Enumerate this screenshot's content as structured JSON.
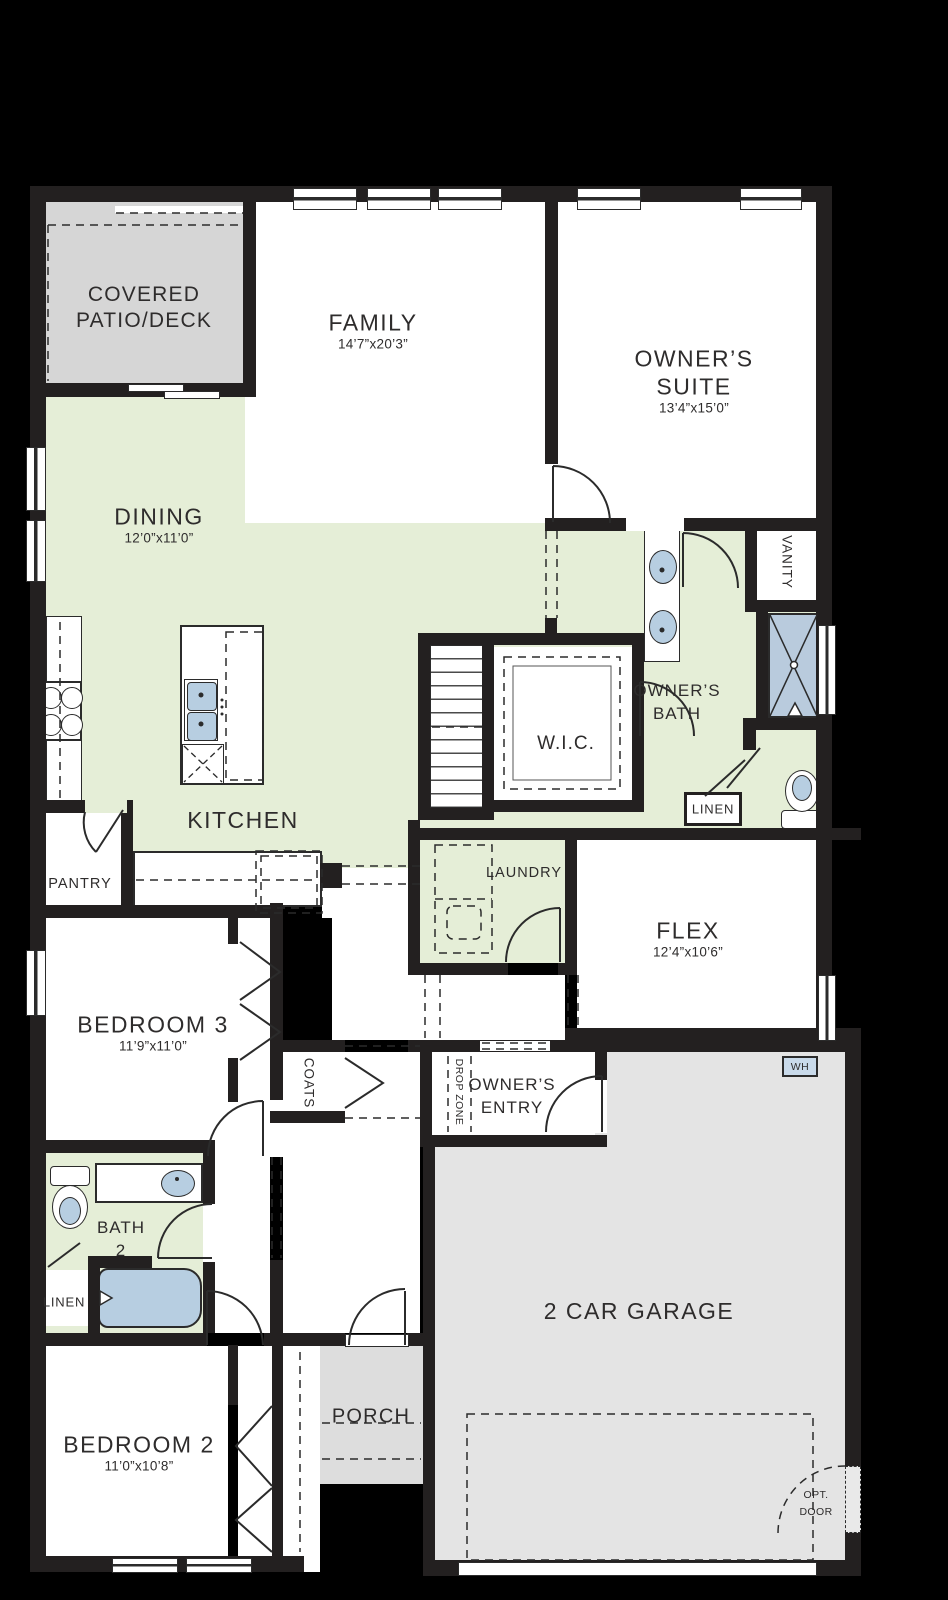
{
  "colors": {
    "background": "#000000",
    "wall": "#232020",
    "room_white": "#ffffff",
    "green": "#e5eed7",
    "patio_gray": "#d6d6d6",
    "porch_gray": "#dddddd",
    "garage_gray": "#e4e4e4",
    "fixture_blue": "#b7cee1",
    "line": "#2b2b2b"
  },
  "rooms": {
    "patio": {
      "line1": "COVERED",
      "line2": "PATIO/DECK"
    },
    "family": {
      "name": "FAMILY",
      "dims": "14’7”x20’3”"
    },
    "owners_suite": {
      "line1": "OWNER’S",
      "line2": "SUITE",
      "dims": "13’4”x15’0”"
    },
    "dining": {
      "name": "DINING",
      "dims": "12’0”x11’0”"
    },
    "vanity": {
      "name": "VANITY"
    },
    "owners_bath": {
      "line1": "OWNER’S",
      "line2": "BATH"
    },
    "wic": {
      "name": "W.I.C."
    },
    "kitchen": {
      "name": "KITCHEN"
    },
    "pantry": {
      "name": "PANTRY"
    },
    "linen_owner": {
      "name": "LINEN"
    },
    "laundry": {
      "name": "LAUNDRY"
    },
    "flex": {
      "name": "FLEX",
      "dims": "12’4”x10’6”"
    },
    "bedroom3": {
      "name": "BEDROOM 3",
      "dims": "11’9”x11’0”"
    },
    "coats": {
      "name": "COATS"
    },
    "drop_zone": {
      "name": "DROP ZONE"
    },
    "owners_entry": {
      "line1": "OWNER’S",
      "line2": "ENTRY"
    },
    "water_heater": {
      "name": "WH"
    },
    "garage": {
      "name": "2 CAR GARAGE"
    },
    "bath2": {
      "line1": "BATH",
      "line2": "2"
    },
    "linen_bath2": {
      "name": "LINEN"
    },
    "bedroom2": {
      "name": "BEDROOM 2",
      "dims": "11’0”x10’8”"
    },
    "porch": {
      "name": "PORCH"
    },
    "optional_door": {
      "line1": "OPT.",
      "line2": "DOOR"
    }
  }
}
